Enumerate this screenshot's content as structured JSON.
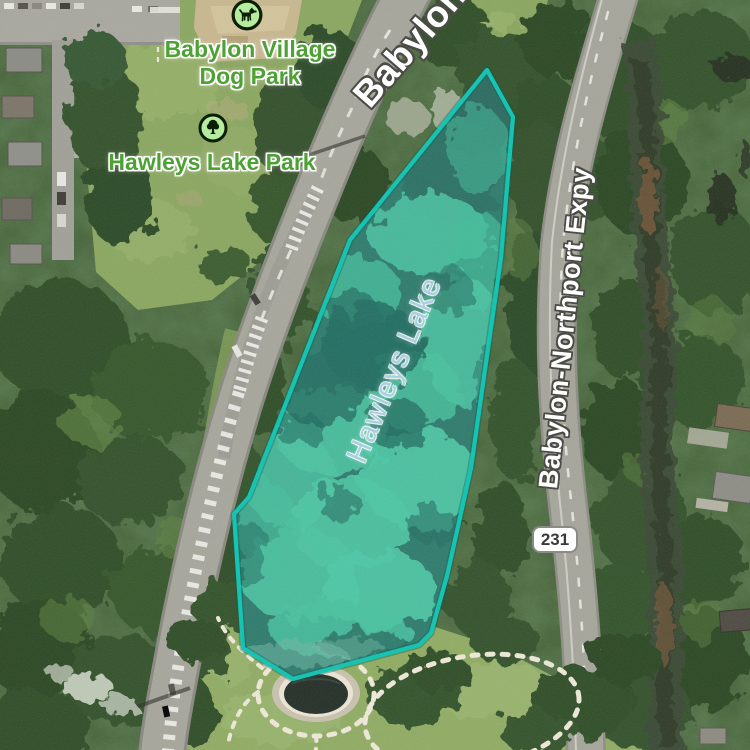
{
  "map": {
    "dog_park": {
      "line1": "Babylon Village",
      "line2": "Dog Park",
      "icon": "dog-icon"
    },
    "lake_park": {
      "name": "Hawleys Lake Park",
      "icon": "tree-icon"
    },
    "water_feature": {
      "name": "Hawleys Lake"
    },
    "road_labels": {
      "top": "Babylon-Northport Expy",
      "right": "Babylon-Northport Expy"
    },
    "route_shield": {
      "number": "231"
    },
    "colors": {
      "selection_stroke": "#0cc4b2",
      "selection_fill": "rgba(45,214,196,0.17)",
      "park_label_green": "#4da135",
      "water_label_blue": "#a9cfe1",
      "shield_background": "#ffffff"
    }
  }
}
